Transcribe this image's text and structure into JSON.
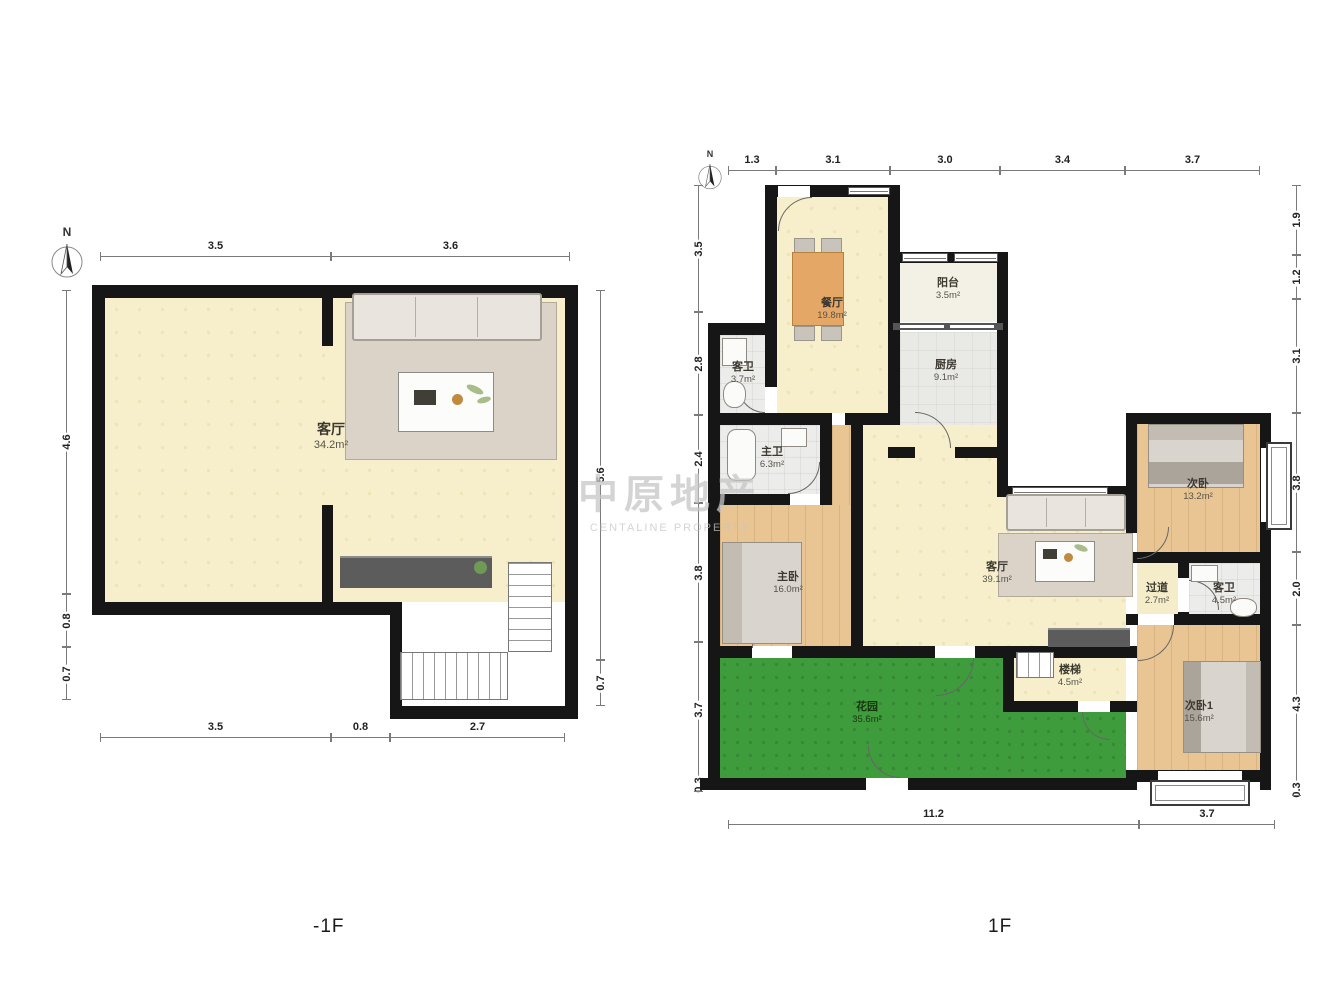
{
  "watermark": {
    "line1": "中原地产",
    "line2": "CENTALINE PROPERTY"
  },
  "m1f": {
    "floor_label": "-1F",
    "north_label": "N",
    "rooms": {
      "living": {
        "name": "客厅",
        "area": "34.2m²"
      }
    },
    "dims": {
      "top": [
        "3.5",
        "3.6"
      ],
      "left": [
        "4.6",
        "0.8",
        "0.7"
      ],
      "right": [
        "5.6",
        "0.7"
      ],
      "bottom": [
        "3.5",
        "0.8",
        "2.7"
      ]
    }
  },
  "f1": {
    "floor_label": "1F",
    "north_label": "N",
    "rooms": {
      "dining": {
        "name": "餐厅",
        "area": "19.8m²"
      },
      "balcony": {
        "name": "阳台",
        "area": "3.5m²"
      },
      "kitchen": {
        "name": "厨房",
        "area": "9.1m²"
      },
      "guest_bath_upper": {
        "name": "客卫",
        "area": "3.7m²"
      },
      "master_bath": {
        "name": "主卫",
        "area": "6.3m²"
      },
      "master_bed": {
        "name": "主卧",
        "area": "16.0m²"
      },
      "living": {
        "name": "客厅",
        "area": "39.1m²"
      },
      "second_bed": {
        "name": "次卧",
        "area": "13.2m²"
      },
      "hallway": {
        "name": "过道",
        "area": "2.7m²"
      },
      "guest_bath": {
        "name": "客卫",
        "area": "4.5m²"
      },
      "stairs": {
        "name": "楼梯",
        "area": "4.5m²"
      },
      "garden": {
        "name": "花园",
        "area": "35.6m²"
      },
      "second_bed_1": {
        "name": "次卧1",
        "area": "15.6m²"
      }
    },
    "dims": {
      "top": [
        "1.3",
        "3.1",
        "3.0",
        "3.4",
        "3.7"
      ],
      "left": [
        "3.5",
        "2.8",
        "2.4",
        "3.8",
        "3.7",
        "0.3"
      ],
      "right": [
        "1.9",
        "1.2",
        "3.1",
        "3.8",
        "2.0",
        "4.3",
        "0.3"
      ],
      "bottom": [
        "11.2",
        "3.7"
      ]
    }
  }
}
